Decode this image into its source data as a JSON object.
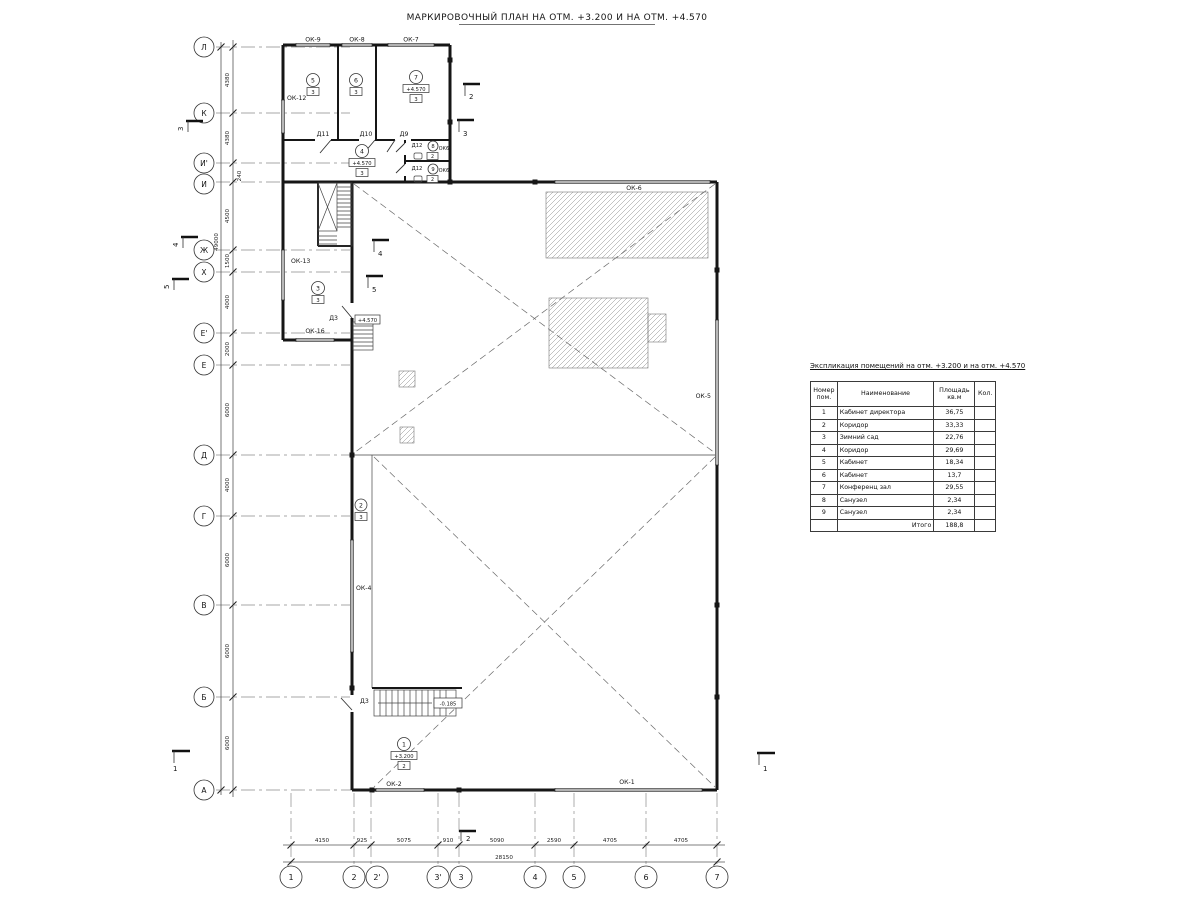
{
  "page": {
    "title": "МАРКИРОВОЧНЫЙ ПЛАН НА ОТМ. +3.200 И НА ОТМ. +4.570"
  },
  "axes": {
    "left": [
      "Л",
      "К",
      "И'",
      "И",
      "Ж",
      "Х",
      "Е'",
      "Е",
      "Д",
      "Г",
      "В",
      "Б",
      "А"
    ],
    "left_dims": [
      "4380",
      "4380",
      "240",
      "4500",
      "1500",
      "4000",
      "2000",
      "6000",
      "4000",
      "6000",
      "6000",
      "6000"
    ],
    "left_total": "49000",
    "bottom": [
      "1",
      "2",
      "2'",
      "3'",
      "3",
      "4",
      "5",
      "6",
      "7"
    ],
    "bottom_dims": [
      "4150",
      "925",
      "5075",
      "910",
      "5090",
      "2590",
      "4705",
      "4705"
    ],
    "bottom_total": "28150"
  },
  "marks": {
    "windows": {
      "ok9": "ОК-9",
      "ok8": "ОК-8",
      "ok7": "ОК-7",
      "ok12": "ОК-12",
      "ok13": "ОК-13",
      "ok16": "ОК-16",
      "ok6": "ОК-6",
      "ok5": "ОК-5",
      "ok4": "ОК-4",
      "ok2": "ОК-2",
      "ok1": "ОК-1",
      "ok6a": "ОК6",
      "ok6b": "ОК6"
    },
    "doors": {
      "d11": "Д11",
      "d10": "Д10",
      "d9": "Д9",
      "d12a": "Д12",
      "d12b": "Д12",
      "d3a": "Д3",
      "d3b": "Д3"
    },
    "sections": {
      "s3l": "3",
      "s4l": "4",
      "s5l": "5",
      "s1l": "1",
      "s2t": "2",
      "s3r": "3",
      "s4m": "4",
      "s5m": "5",
      "s2b": "2",
      "s1r": "1"
    },
    "elevations": {
      "stair_up": "+4.570",
      "stair_low": "-0.185"
    }
  },
  "rooms": [
    {
      "num": "5",
      "type": "3"
    },
    {
      "num": "6",
      "type": "3"
    },
    {
      "num": "7",
      "elev": "+4.570",
      "type": "3"
    },
    {
      "num": "4",
      "elev": "+4.570",
      "type": "3"
    },
    {
      "num": "3",
      "type": "3"
    },
    {
      "num": "8",
      "type": "2"
    },
    {
      "num": "9",
      "type": "2"
    },
    {
      "num": "1",
      "elev": "+3.200",
      "type": "2"
    },
    {
      "num": "2",
      "type": "3"
    }
  ],
  "table": {
    "title": "Экспликация помещений на отм. +3.200 и на отм. +4.570",
    "headers": {
      "num1": "Номер",
      "num2": "пом.",
      "name": "Наименование",
      "area1": "Площадь",
      "area2": "кв.м",
      "qty": "Кол."
    },
    "rows": [
      {
        "num": "1",
        "name": "Кабинет директора",
        "area": "36,75",
        "qty": ""
      },
      {
        "num": "2",
        "name": "Коридор",
        "area": "33,33",
        "qty": ""
      },
      {
        "num": "3",
        "name": "Зимний сад",
        "area": "22,76",
        "qty": ""
      },
      {
        "num": "4",
        "name": "Коридор",
        "area": "29,69",
        "qty": ""
      },
      {
        "num": "5",
        "name": "Кабинет",
        "area": "18,34",
        "qty": ""
      },
      {
        "num": "6",
        "name": "Кабинет",
        "area": "13,7",
        "qty": ""
      },
      {
        "num": "7",
        "name": "Конференц зал",
        "area": "29,55",
        "qty": ""
      },
      {
        "num": "8",
        "name": "Санузел",
        "area": "2,34",
        "qty": ""
      },
      {
        "num": "9",
        "name": "Санузел",
        "area": "2,34",
        "qty": ""
      }
    ],
    "total_label": "Итого",
    "total_value": "188,8"
  }
}
